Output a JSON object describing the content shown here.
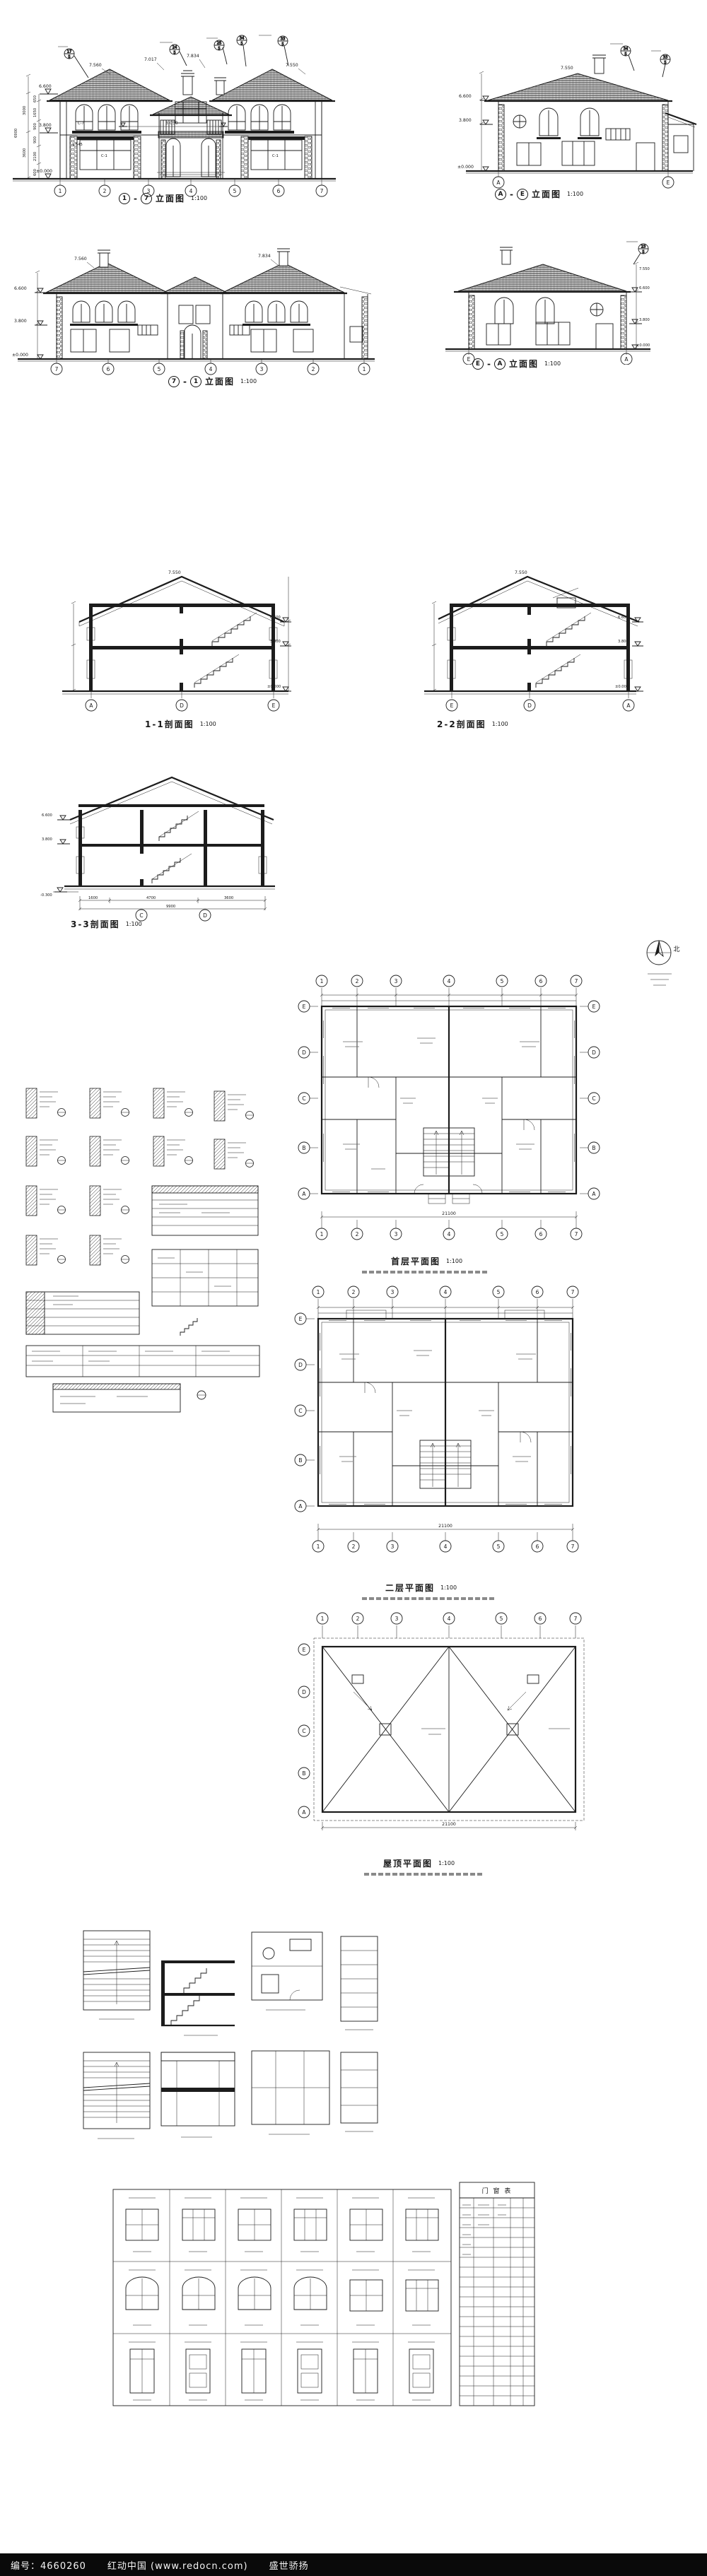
{
  "sep": "-",
  "scale100": "1:100",
  "captions": {
    "front": {
      "from": "1",
      "to": "7",
      "name": "立面图"
    },
    "side_ae": {
      "from": "A",
      "to": "E",
      "name": "立面图"
    },
    "back": {
      "from": "7",
      "to": "1",
      "name": "立面图"
    },
    "side_ea": {
      "from": "E",
      "to": "A",
      "name": "立面图"
    },
    "s1": "1-1剖面图",
    "s2": "2-2剖面图",
    "s3": "3-3剖面图",
    "p1": "首层平面图",
    "p2": "二层平面图",
    "roof": "屋顶平面图",
    "schedule": "门 窗 表"
  },
  "compass": {
    "label": "北"
  },
  "axes": {
    "nums": [
      "1",
      "2",
      "3",
      "4",
      "5",
      "6",
      "7"
    ],
    "nums_rev": [
      "7",
      "6",
      "5",
      "4",
      "3",
      "2",
      "1"
    ],
    "letters": [
      "E",
      "D",
      "C",
      "B",
      "A"
    ],
    "s1": [
      "A",
      "D",
      "E"
    ],
    "s2": [
      "E",
      "D",
      "A"
    ],
    "s3": [
      "C",
      "D"
    ],
    "ae": [
      "A",
      "E"
    ],
    "ea": [
      "E",
      "A"
    ]
  },
  "levels": {
    "front": {
      "eave": "6.600",
      "floor2": "3.800",
      "ground": "±0.000",
      "ridge1": "7.560",
      "ridge2": "7.017",
      "ridge3": "7.834",
      "ridge4": "7.550",
      "mid": "3.050",
      "sill": "1.545"
    },
    "side": {
      "top": "7.550",
      "eave": "6.600",
      "floor2": "3.800",
      "ground": "±0.000"
    },
    "s3": {
      "base": "-0.300"
    }
  },
  "windows": {
    "c7": "C-7",
    "c1": "C-1"
  },
  "dims": {
    "front": {
      "segs": [
        "650",
        "1650",
        "900",
        "900",
        "2100",
        "600"
      ],
      "totals": [
        "3000",
        "3600",
        "6900"
      ]
    },
    "plan": {
      "total": "21100"
    },
    "s3": {
      "segs": [
        "1600",
        "4700",
        "3600"
      ],
      "total": "9900"
    }
  },
  "detail_refs": {
    "sheet": "5",
    "a": "17",
    "b": "24",
    "c": "25",
    "d": "34",
    "e": "33",
    "f": "23"
  },
  "footer": {
    "code": "编号：4660260",
    "site": "红动中国 (www.redocn.com)",
    "brand": "盛世骄扬"
  }
}
